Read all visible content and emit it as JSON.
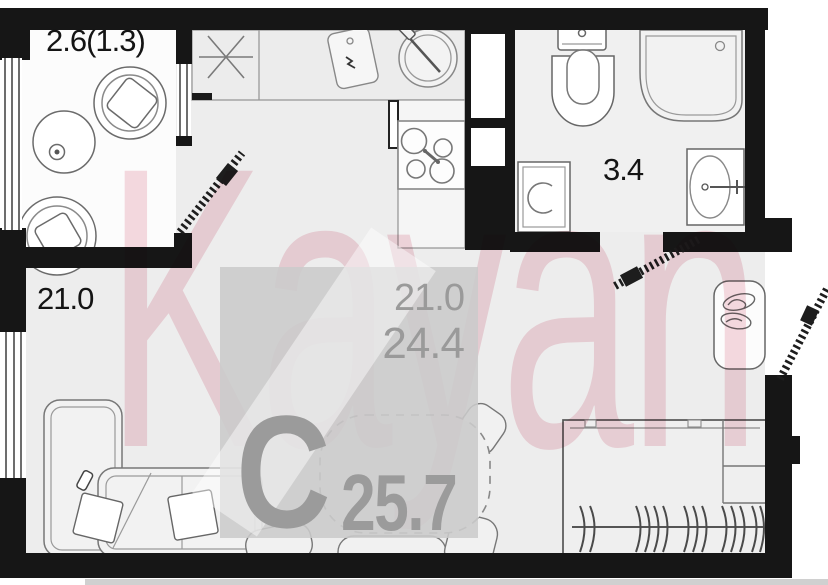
{
  "watermark": {
    "text": "Kayan",
    "color": "#f6dbe1"
  },
  "rooms": {
    "balcony": {
      "area_label": "2.6(1.3)"
    },
    "living_room": {
      "area_label": "21.0"
    },
    "bathroom": {
      "area_label": "3.4"
    }
  },
  "overlay": {
    "living_area": "21.0",
    "total_area": "24.4",
    "plan_type_letter": "С",
    "total_area_big": "25.7"
  },
  "colors": {
    "wall": "#161616",
    "floor": "#ededed",
    "bathroom_floor": "#f0f0f0",
    "overlay_box": "#cbcbcb",
    "overlay_text": "#9b9b9b",
    "watermark_pink": "#f6dbe1"
  },
  "fixtures": {
    "balcony": [
      "round-table",
      "armchair",
      "armchair"
    ],
    "kitchen": [
      "kitchen-counter",
      "extractor-symbol",
      "cutting-board",
      "round-sink",
      "cooktop"
    ],
    "bathroom": [
      "toilet",
      "corner-bath",
      "washing-machine",
      "wash-basin"
    ],
    "living_room": [
      "corner-sofa",
      "pillows",
      "dining-table",
      "chairs",
      "wardrobe-with-hangers",
      "shoe-cabinet"
    ],
    "doors": [
      "balcony-door",
      "bathroom-door",
      "entrance-door"
    ]
  }
}
